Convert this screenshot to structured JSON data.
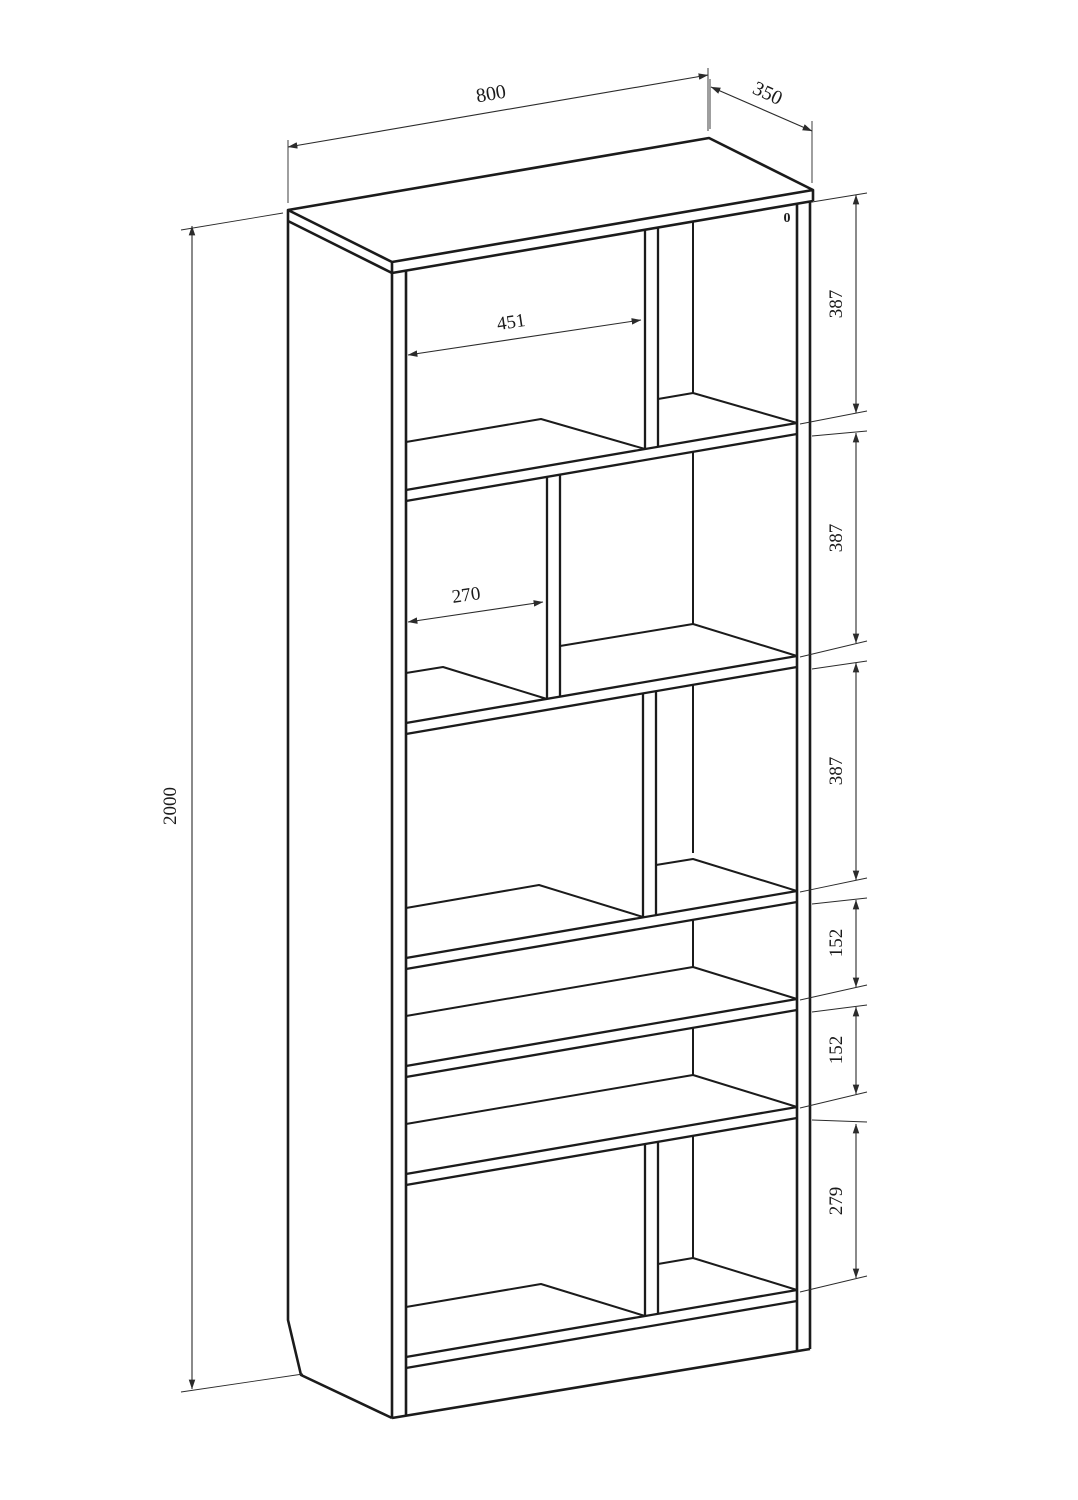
{
  "drawing": {
    "object": "bookshelf-cabinet",
    "view": "axonometric-line-drawing",
    "line_color": "#1b1b1b",
    "dimension_color": "#2b2b2b",
    "background": "#ffffff",
    "dims": {
      "width": "800",
      "depth": "350",
      "height": "2000",
      "top_compartment_width": "451",
      "middle_compartment_width": "270",
      "section_heights": [
        "387",
        "387",
        "387",
        "152",
        "152",
        "279"
      ]
    },
    "hole_mark": "0"
  }
}
